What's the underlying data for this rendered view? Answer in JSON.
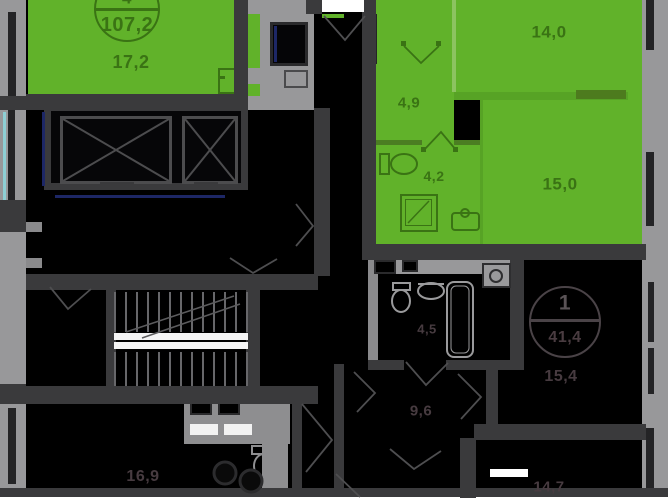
{
  "apartment_selected": {
    "badge_rooms": "4",
    "badge_area": "107,2",
    "room_living": "17,2",
    "room_bedroom": "14,0",
    "room_hall": "4,9",
    "room_bath": "4,2",
    "room_second": "15,0"
  },
  "apartment_other": {
    "badge_rooms": "1",
    "badge_area": "41,4",
    "room_main": "15,4"
  },
  "other_rooms": {
    "room_bottom_left": "16,9",
    "room_middle": "9,6",
    "room_small_bath": "4,5",
    "room_bottom_right": "14,7"
  },
  "colors": {
    "apartment_green": "#61b22a",
    "green_text": "#3a7314",
    "wall_dark": "#3a3a3c",
    "wall_gray": "#98989a",
    "room_background": "#000000",
    "window_blue": "#1d2766",
    "glass_cyan": "#8ecfd4"
  }
}
